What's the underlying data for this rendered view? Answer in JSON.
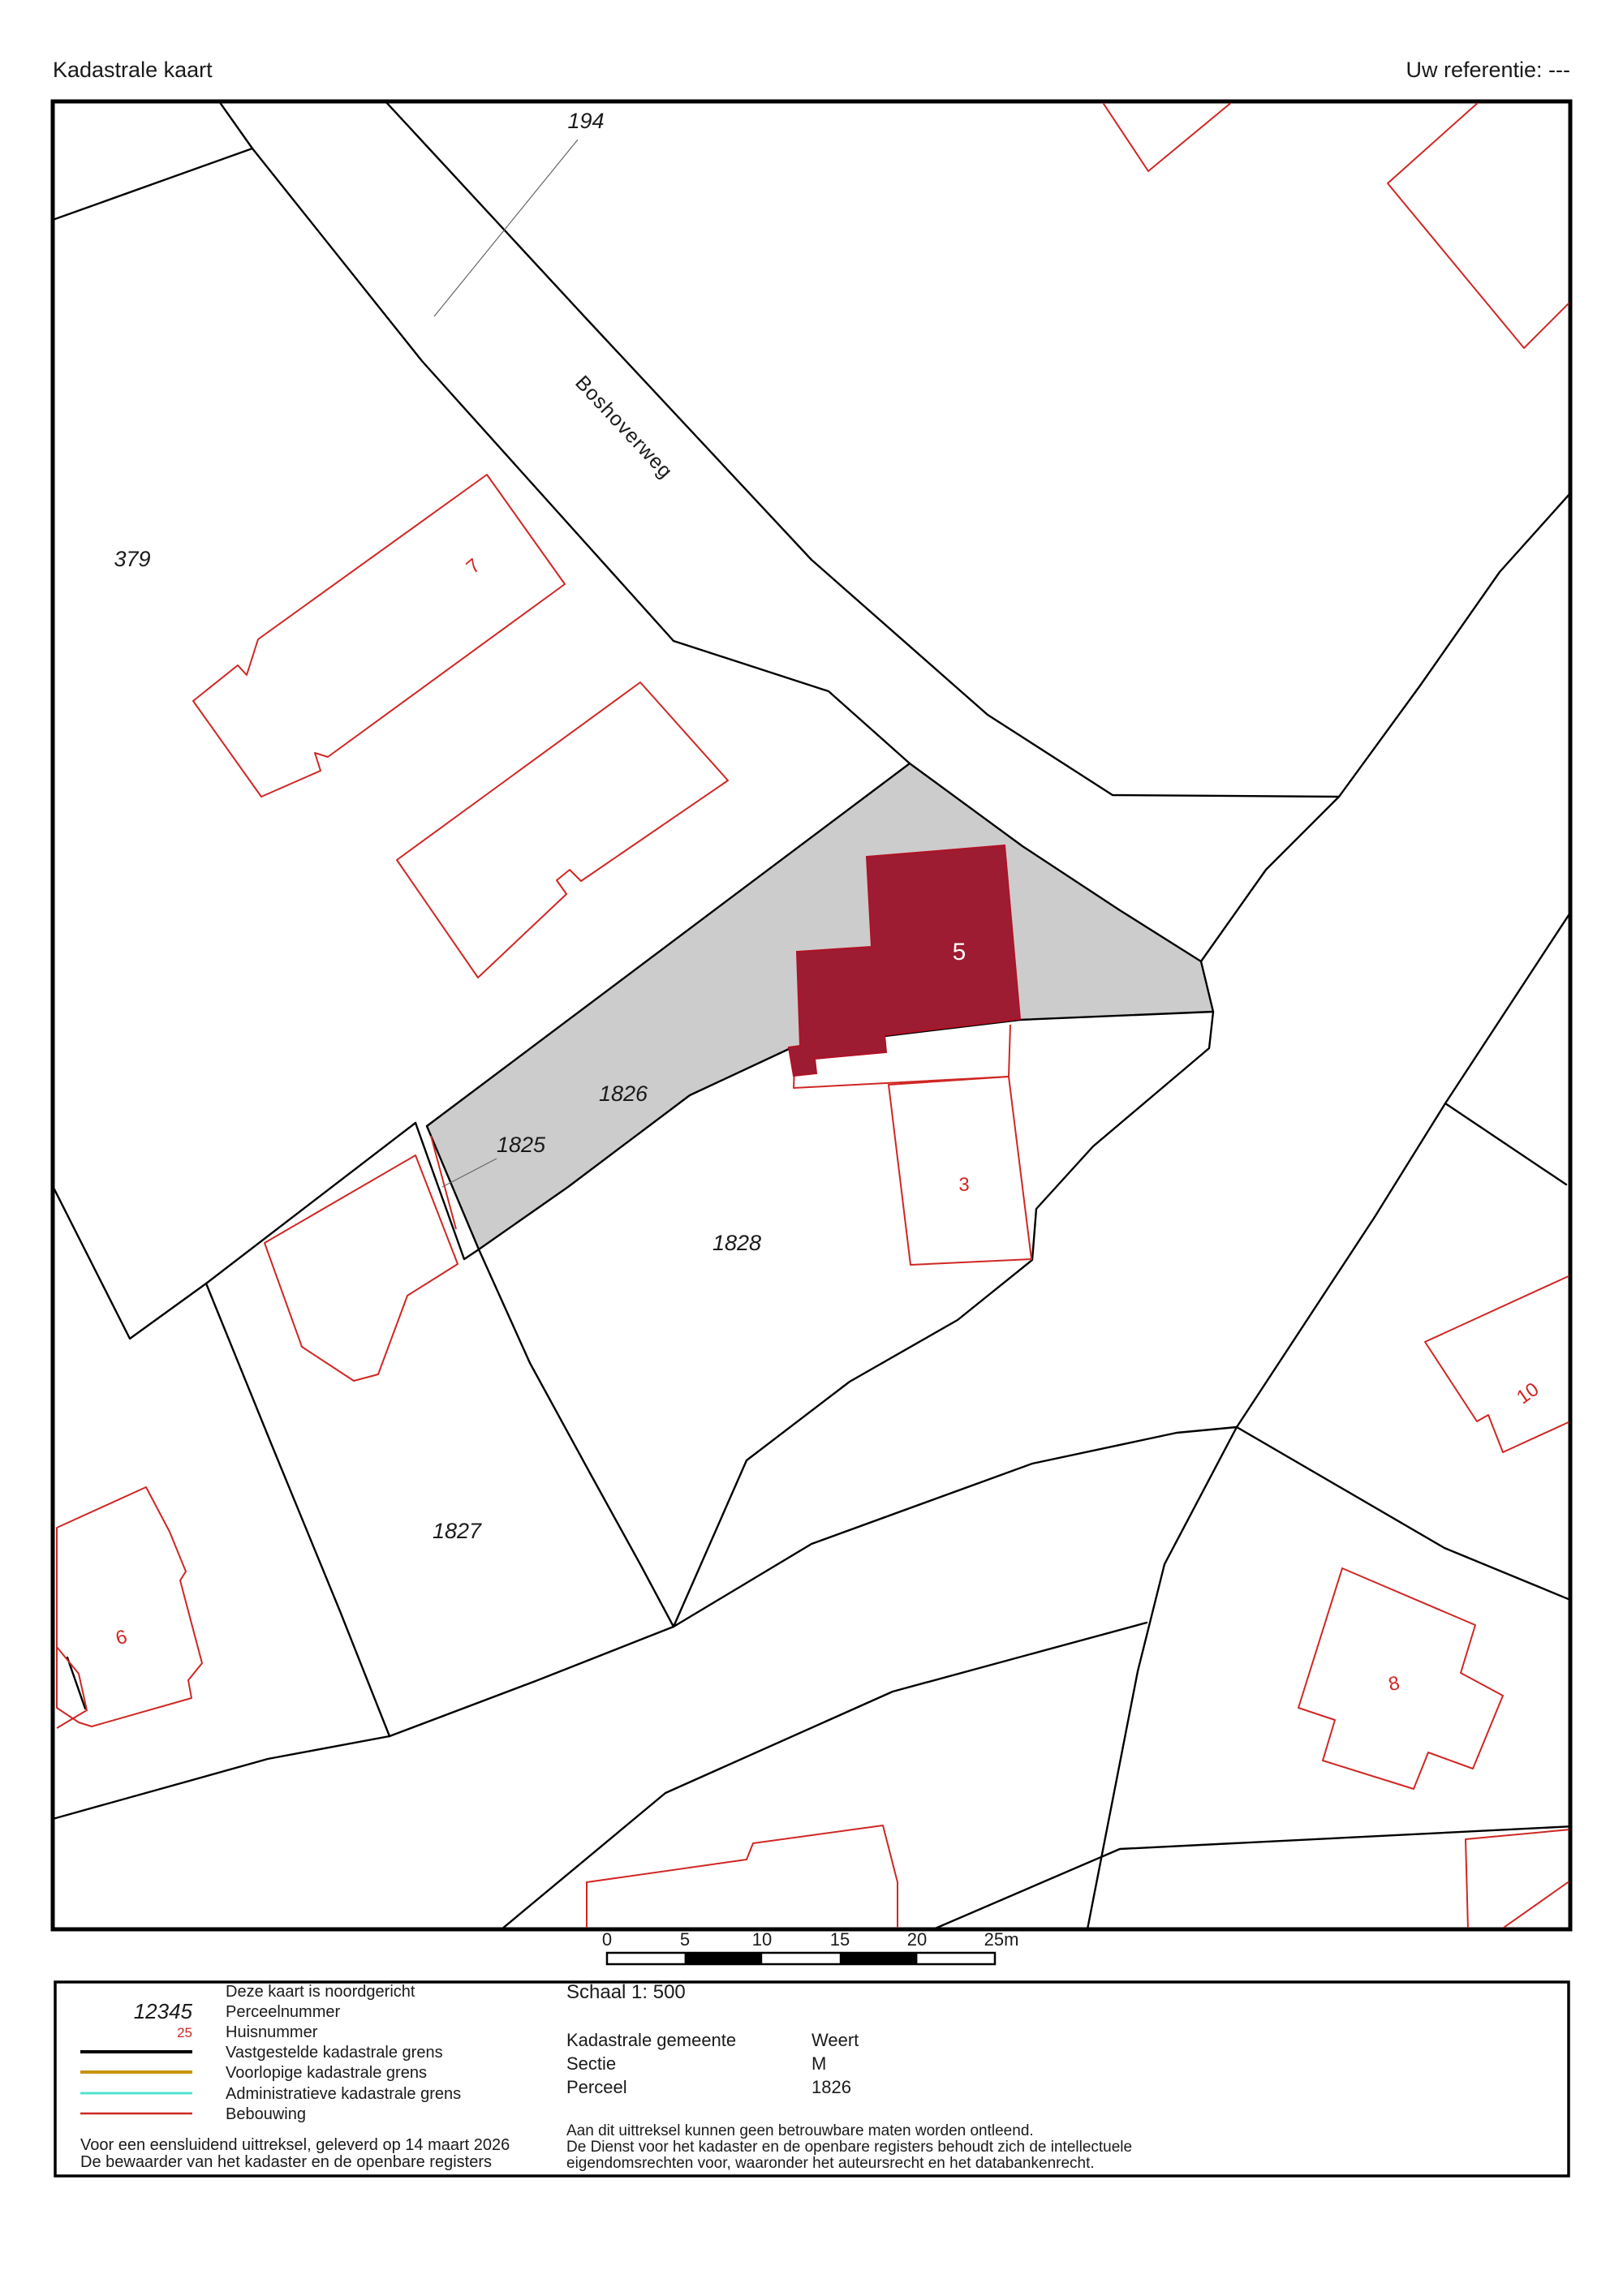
{
  "header": {
    "title": "Kadastrale kaart",
    "reference": "Uw referentie: ---"
  },
  "map": {
    "street_label": "Boshoverweg",
    "labels": {
      "l194": "194",
      "l379": "379",
      "l1826": "1826",
      "l1825": "1825",
      "l1828": "1828",
      "l1827": "1827"
    },
    "house_numbers": {
      "h5": "5",
      "h3": "3",
      "h7": "7",
      "h6": "6",
      "h10": "10",
      "h8": "8"
    },
    "highlight_parcel_fill": "#cccccc",
    "selected_building_fill": "#9d1c31",
    "building_outline_color": "#cf2724",
    "boundary_color": "#000000"
  },
  "scalebar": {
    "ticks": [
      "0",
      "5",
      "10",
      "15",
      "20",
      "25m"
    ]
  },
  "legend": {
    "north_note": "Deze kaart is noordgericht",
    "items": [
      {
        "symbol": "12345",
        "label": "Perceelnummer"
      },
      {
        "symbol": "25",
        "label": "Huisnummer",
        "color": "#cf2724"
      },
      {
        "label": "Vastgestelde kadastrale grens",
        "color": "#000000"
      },
      {
        "label": "Voorlopige kadastrale grens",
        "color": "#c8940a"
      },
      {
        "label": "Administratieve kadastrale grens",
        "color": "#4ee3cf"
      },
      {
        "label": "Bebouwing",
        "color": "#cf2724"
      }
    ],
    "delivery_line1": "Voor een eensluidend uittreksel, geleverd op 14 maart 2026",
    "delivery_line2": "De bewaarder van het kadaster en de openbare registers"
  },
  "details": {
    "scale": "Schaal 1: 500",
    "rows": [
      {
        "label": "Kadastrale gemeente",
        "value": "Weert"
      },
      {
        "label": "Sectie",
        "value": "M"
      },
      {
        "label": "Perceel",
        "value": "1826"
      }
    ],
    "disclaimer": [
      "Aan dit uittreksel kunnen geen betrouwbare maten worden ontleend.",
      "De Dienst voor het kadaster en de openbare registers behoudt zich de intellectuele",
      "eigendomsrechten voor, waaronder het auteursrecht en het databankenrecht."
    ]
  }
}
